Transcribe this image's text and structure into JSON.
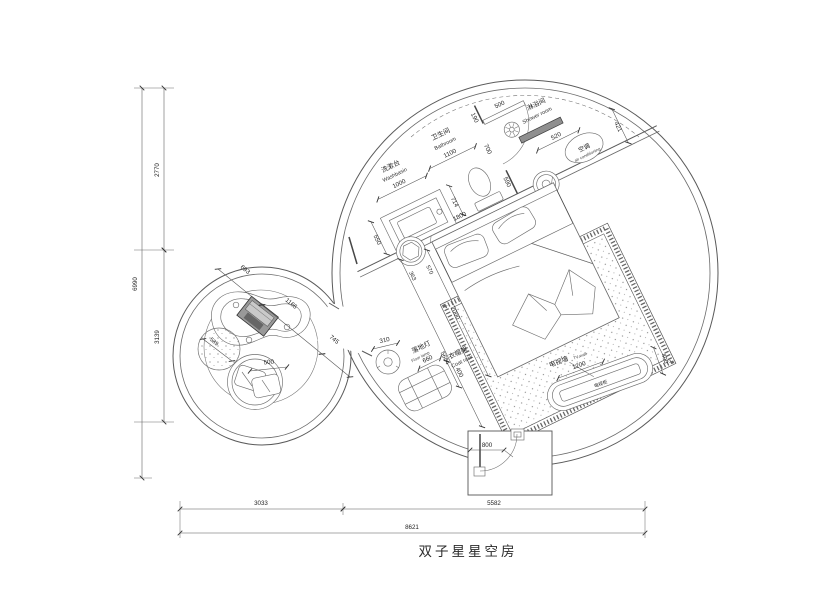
{
  "title": "双子星星空房",
  "rooms": {
    "washbasin": {
      "zh": "洗漱台",
      "en": "Washbasin",
      "width": "1000"
    },
    "bathroom": {
      "zh": "卫生间",
      "en": "Bathroom",
      "width": "1100"
    },
    "shower": {
      "zh": "淋浴间",
      "en": "Shower room"
    },
    "ac": {
      "zh": "空调",
      "en": "air conditioning"
    },
    "floor_lamp": {
      "zh": "落地灯",
      "en": "Floor lamp",
      "dia": "310"
    },
    "coat_rack": {
      "zh": "衣帽架",
      "en": "Coat rack",
      "width": "660",
      "depth": "400"
    },
    "tv": {
      "zh": "电视墙",
      "en": "TV wall",
      "cabinet": "电视柜",
      "width": "1200",
      "depth": "400"
    }
  },
  "dims": {
    "plan_height": "6990",
    "plan_top": "2770",
    "plan_mid": "3139",
    "bottom_left": "3033",
    "bottom_right": "5582",
    "bottom_total": "8621",
    "bed_width": "1800",
    "bed_length": "2000",
    "room_diag": "5684",
    "basin_depth": "550",
    "basin_toilet_gap": "714",
    "toilet_side": "590",
    "partition_top": "190",
    "bath_door": "700",
    "bath_door_leaf": "500",
    "shower_bar": "520",
    "ac_clear": "421",
    "stool_a": "363",
    "stool_b": "570",
    "entry_door": "800",
    "lounge_a": "693",
    "lounge_table": "1166",
    "lounge_b": "745",
    "pouf_small": "589",
    "pouf_large": "500"
  },
  "colors": {
    "wall": "#5a5a5a",
    "text": "#1f1f1f",
    "fill_dark": "#8f8f8f"
  }
}
